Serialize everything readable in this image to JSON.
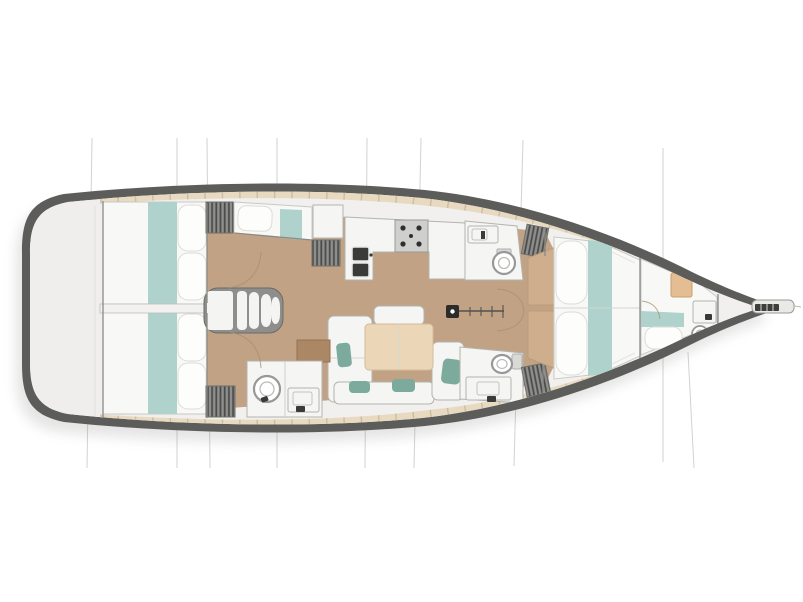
{
  "page": {
    "background": "#ffffff",
    "description": "Top-down interior layout plan of a sailing yacht, bow pointing right, stern platform on the left"
  },
  "diagram": {
    "title": "Sailing yacht interior layout plan (top view, bow to the right)",
    "orientation": {
      "bow": "right",
      "stern": "left"
    },
    "regions": [
      {
        "id": "swim-platform",
        "label": "Transom / stern platform locker",
        "position": "far left"
      },
      {
        "id": "aft-cabin-top",
        "label": "Aft double cabin (upper side)",
        "features": [
          "double berth",
          "teal bed runner",
          "two pillows",
          "louvered wardrobe"
        ]
      },
      {
        "id": "aft-cabin-bottom",
        "label": "Aft double cabin (lower side)",
        "features": [
          "double berth",
          "teal bed runner",
          "two pillows",
          "louvered wardrobe"
        ]
      },
      {
        "id": "companionway",
        "label": "Companionway steps between aft cabins",
        "features": [
          "landing",
          "four curved steps"
        ]
      },
      {
        "id": "single-berth",
        "label": "Single berth beside companionway (upper side)",
        "features": [
          "berth with teal runner",
          "pillow",
          "louvered locker",
          "white cabinet"
        ]
      },
      {
        "id": "galley",
        "label": "L-shaped galley (upper side)",
        "features": [
          "double sink",
          "stove with burners",
          "worktops"
        ]
      },
      {
        "id": "head-upper",
        "label": "Forward head (upper side)",
        "features": [
          "toilet",
          "vanity sink",
          "louvered locker"
        ]
      },
      {
        "id": "salon",
        "label": "Salon / dinette (center)",
        "features": [
          "U-shaped settee",
          "rectangular wood table",
          "teal accent cushions",
          "nav desk"
        ]
      },
      {
        "id": "head-lower-aft",
        "label": "Aft head with shower (lower side)",
        "features": [
          "round shower column",
          "vanity sink"
        ]
      },
      {
        "id": "head-lower-fwd",
        "label": "Forward head (lower side)",
        "features": [
          "toilet with tank",
          "vanity sink",
          "louvered locker"
        ]
      },
      {
        "id": "fore-cabin",
        "label": "Forward double cabin",
        "features": [
          "island V-berth",
          "teal runner",
          "scalloped pillows",
          "wood side platforms"
        ]
      },
      {
        "id": "bow-cabin",
        "label": "Bow crew cabin",
        "features": [
          "single berth with teal runner",
          "pillow",
          "wood nightstand",
          "washbasin",
          "small toilet"
        ]
      },
      {
        "id": "bowsprit",
        "label": "Bowsprit / anchor fitting",
        "position": "far right tip"
      },
      {
        "id": "mast",
        "label": "Mast foot with track and fittings",
        "position": "center, forward of salon"
      },
      {
        "id": "section-lines",
        "label": "Thin rigging/section lines crossing the hull vertically"
      }
    ]
  },
  "colors": {
    "hull": "#5c5c5a",
    "interior": "#f1f0ee",
    "transom": "#efeeec",
    "deck_trim": "#e7dac1",
    "deck_seam": "#cdbd9e",
    "floor_wood": "#c2a284",
    "floor_wood_light": "#cfae8e",
    "furniture_white": "#f5f5f3",
    "outline": "#b3b3af",
    "bed_linen": "#f8f8f6",
    "pillow": "#fdfdfb",
    "bed_runner_teal": "#afd3cc",
    "cushion_teal": "#7cab9e",
    "locker_gray": "#8f8f8d",
    "locker_slat": "#4c4c4a",
    "table_wood": "#ebd7b8",
    "desk_wood": "#ab8765",
    "nightstand_wood": "#e5bd92",
    "stove_panel": "#cfcfcd",
    "burner": "#2f2f2d",
    "sink_dark": "#3a3a38",
    "wall": "#8a8a86",
    "door_arc": "#a3906f",
    "section_line": "#adadab",
    "mast": "#2c2c2a",
    "shadow": "#70706e"
  }
}
